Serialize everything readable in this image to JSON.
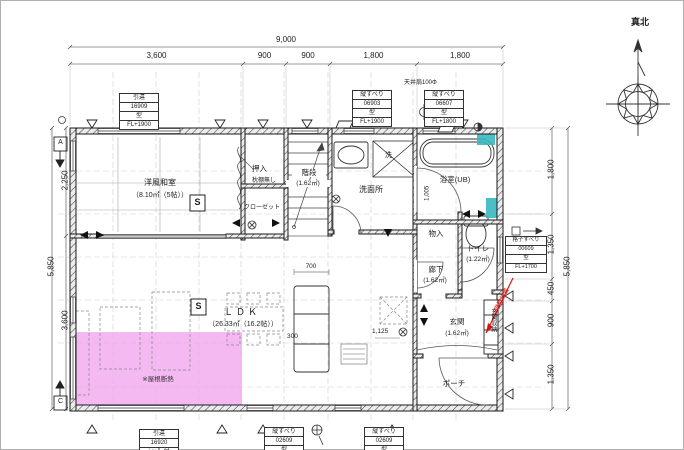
{
  "compass": {
    "north_label": "真北"
  },
  "dims": {
    "top_total": "9,000",
    "top_segments": [
      "3,600",
      "900",
      "900",
      "1,800",
      "1,800"
    ],
    "left_total": "5,850",
    "left_segments": [
      "2,250",
      "3,600"
    ],
    "right_total": "5,850",
    "right_segments": [
      "1,800",
      "1,350",
      "450",
      "900",
      "1,350"
    ],
    "kitchen_width": "700",
    "counter_depth": "300",
    "genkan_width": "1,125",
    "bath_door": "1,005"
  },
  "rooms": {
    "washitsu_name": "洋風和室",
    "washitsu_area": "（8.10㎡（5帖））",
    "oshiire": "押入",
    "makuradana_note": "枕棚無し",
    "closet": "クローゼット",
    "kaidan_name": "階段",
    "kaidan_area": "(1.62㎡)",
    "senmenjo": "洗面所",
    "yokushitsu": "浴室(UB)",
    "monoire": "物入",
    "toilet_name": "トイレ",
    "toilet_area": "(1.22㎡)",
    "rouka_name": "廊下",
    "rouka_area": "(1.62㎡)",
    "ldk_name": "ＬＤＫ",
    "ldk_area": "（26.33㎡（16.2帖））",
    "genkan_name": "玄関",
    "genkan_area": "(1.62㎡)",
    "genkan_shunou": "玄関収納",
    "porch": "ポーチ"
  },
  "notes": {
    "roof_insulation": "※屋根断熱",
    "laundry_mark": "洗",
    "ceiling_fan": "天井扇100Φ",
    "red_annotation": "2階壁位置",
    "smoke_detector": "S",
    "section_a": "A",
    "section_c": "C"
  },
  "window_tags": [
    {
      "rows": [
        "引違",
        "16909",
        "型",
        "FL+1900"
      ]
    },
    {
      "rows": [
        "縦すべり",
        "06903",
        "型",
        "FL+1900"
      ]
    },
    {
      "rows": [
        "縦すべり",
        "06607",
        "型",
        "FL+1800"
      ]
    },
    {
      "rows": [
        "格子すべり",
        "00609",
        "型",
        "FL+1700"
      ]
    },
    {
      "rows": [
        "引違",
        "16920",
        "ｼｬｯﾀｰ付",
        ""
      ]
    },
    {
      "rows": [
        "縦すべり",
        "02609",
        "型",
        ""
      ]
    },
    {
      "rows": [
        "縦すべり",
        "02609",
        "型",
        ""
      ]
    }
  ],
  "colors": {
    "pink": "#f2a2ee",
    "cyan": "#38b8c0",
    "red": "#dd1111"
  }
}
